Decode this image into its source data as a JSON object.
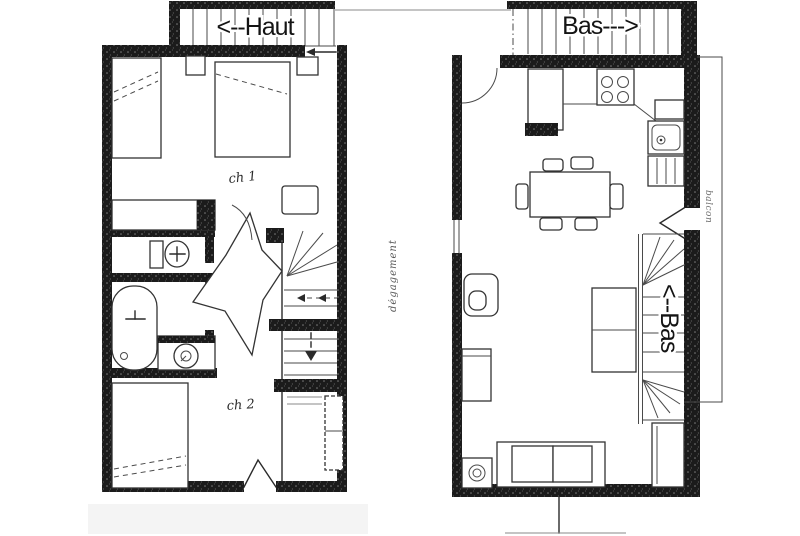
{
  "colors": {
    "ink": "#2a2a2a",
    "wall": "#1a1a1a",
    "paper": "#ffffff"
  },
  "upper_floor": {
    "stairs_label": "<--Haut",
    "bedroom1_label": "ch 1",
    "bedroom2_label": "ch 2",
    "hall_note": "dégagement"
  },
  "lower_floor": {
    "stairs_top_label": "Bas--->",
    "stairs_inner_label": "<--Bas",
    "balcony_label": "balcon"
  }
}
